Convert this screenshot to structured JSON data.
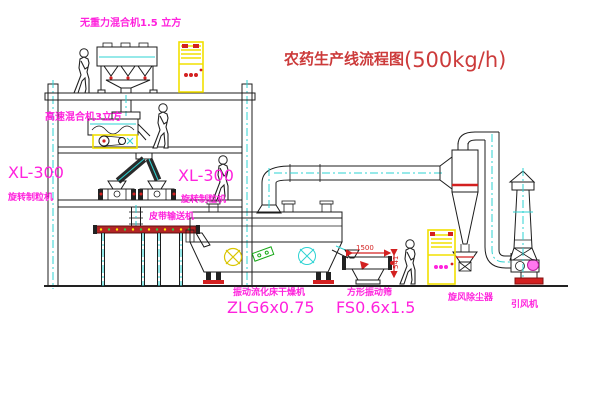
{
  "diagram": {
    "title": "农药生产线流程图",
    "title_capacity": "(500kg/h)"
  },
  "equipment_labels": {
    "gravity_free_mixer": "无重力混合机1.5 立方",
    "high_speed_mixer": "高速混合机3立方",
    "granulator_left": {
      "model": "XL-300",
      "name": "旋转制粒机"
    },
    "granulator_right": {
      "model": "XL-300",
      "name": "旋转制粒机"
    },
    "belt_conveyor": "皮带输送机",
    "fluid_bed_dryer": {
      "name": "振动流化床干燥机",
      "model": "ZLG6x0.75"
    },
    "square_sieve": {
      "name": "方形振动筛",
      "model": "FS0.6x1.5"
    },
    "cyclone": "旋风除尘器",
    "induced_draft_fan": "引风机"
  },
  "dimensions": {
    "sieve_length": "1500",
    "sieve_height": "541"
  },
  "colors": {
    "label_magenta": "#ff22dd",
    "title_red": "#cc3b3b",
    "line_cyan": "#2ed3d3",
    "highlight_yellow": "#f2e000",
    "accent_red": "#d32020",
    "line_black": "#1c1c1c"
  }
}
